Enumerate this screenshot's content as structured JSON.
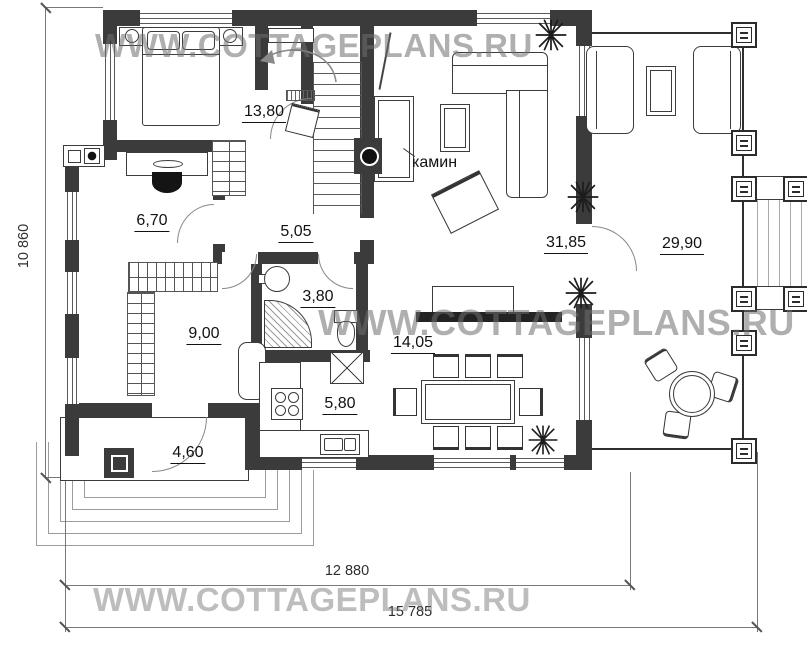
{
  "watermark": {
    "text": "WWW.COTTAGEPLANS.RU"
  },
  "plan": {
    "fireplace_label": "камин",
    "rooms": [
      {
        "id": "bedroom",
        "area": "13,80"
      },
      {
        "id": "study",
        "area": "6,70"
      },
      {
        "id": "hall",
        "area": "5,05"
      },
      {
        "id": "dressing-room",
        "area": "9,00"
      },
      {
        "id": "bathroom",
        "area": "3,80"
      },
      {
        "id": "kitchen",
        "area": "5,80"
      },
      {
        "id": "dining-area",
        "area": "14,05"
      },
      {
        "id": "living-room",
        "area": "31,85"
      },
      {
        "id": "terrace",
        "area": "29,90"
      },
      {
        "id": "porch",
        "area": "4,60"
      }
    ]
  },
  "dimensions": {
    "height_total": "10 860",
    "width_inner": "12 880",
    "width_total": "15 785"
  },
  "colors": {
    "wall": "#3b3b3b",
    "dimension_line": "#787878",
    "watermark_gray": "#6f6f6f"
  }
}
